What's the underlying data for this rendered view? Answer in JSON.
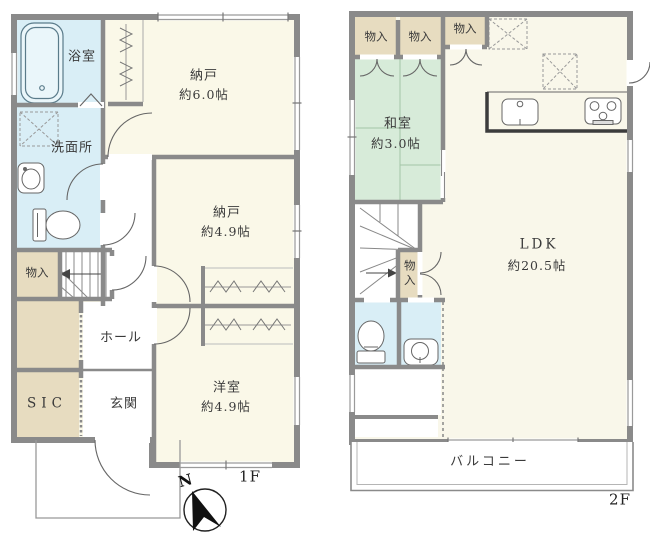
{
  "floor1": {
    "floor_label": "1F",
    "compass_label": "N",
    "bath": {
      "name": "浴室"
    },
    "storage_6": {
      "name": "納戸",
      "size": "約6.0帖"
    },
    "washroom": {
      "name": "洗面所"
    },
    "storage_49": {
      "name": "納戸",
      "size": "約4.9帖"
    },
    "closet": {
      "name": "物入"
    },
    "hall": {
      "name": "ホール"
    },
    "sic": {
      "name": "SIC"
    },
    "entrance": {
      "name": "玄関"
    },
    "western_room": {
      "name": "洋室",
      "size": "約4.9帖"
    }
  },
  "floor2": {
    "floor_label": "2F",
    "closet_1": {
      "name": "物入"
    },
    "closet_2": {
      "name": "物入"
    },
    "closet_3": {
      "name": "物入"
    },
    "closet_4": {
      "name": "物入"
    },
    "japanese_room": {
      "name": "和室",
      "size": "約3.0帖"
    },
    "ldk": {
      "name": "LDK",
      "size": "約20.5帖"
    },
    "balcony": {
      "name": "バルコニー"
    }
  },
  "colors": {
    "wall_gray": "#8a8a8a",
    "room_cream": "#faf8e8",
    "tatami_green": "#d7ebd9",
    "water_blue": "#d9eef6",
    "closet_tan": "#e7dcc0",
    "line_dark": "#555555"
  }
}
